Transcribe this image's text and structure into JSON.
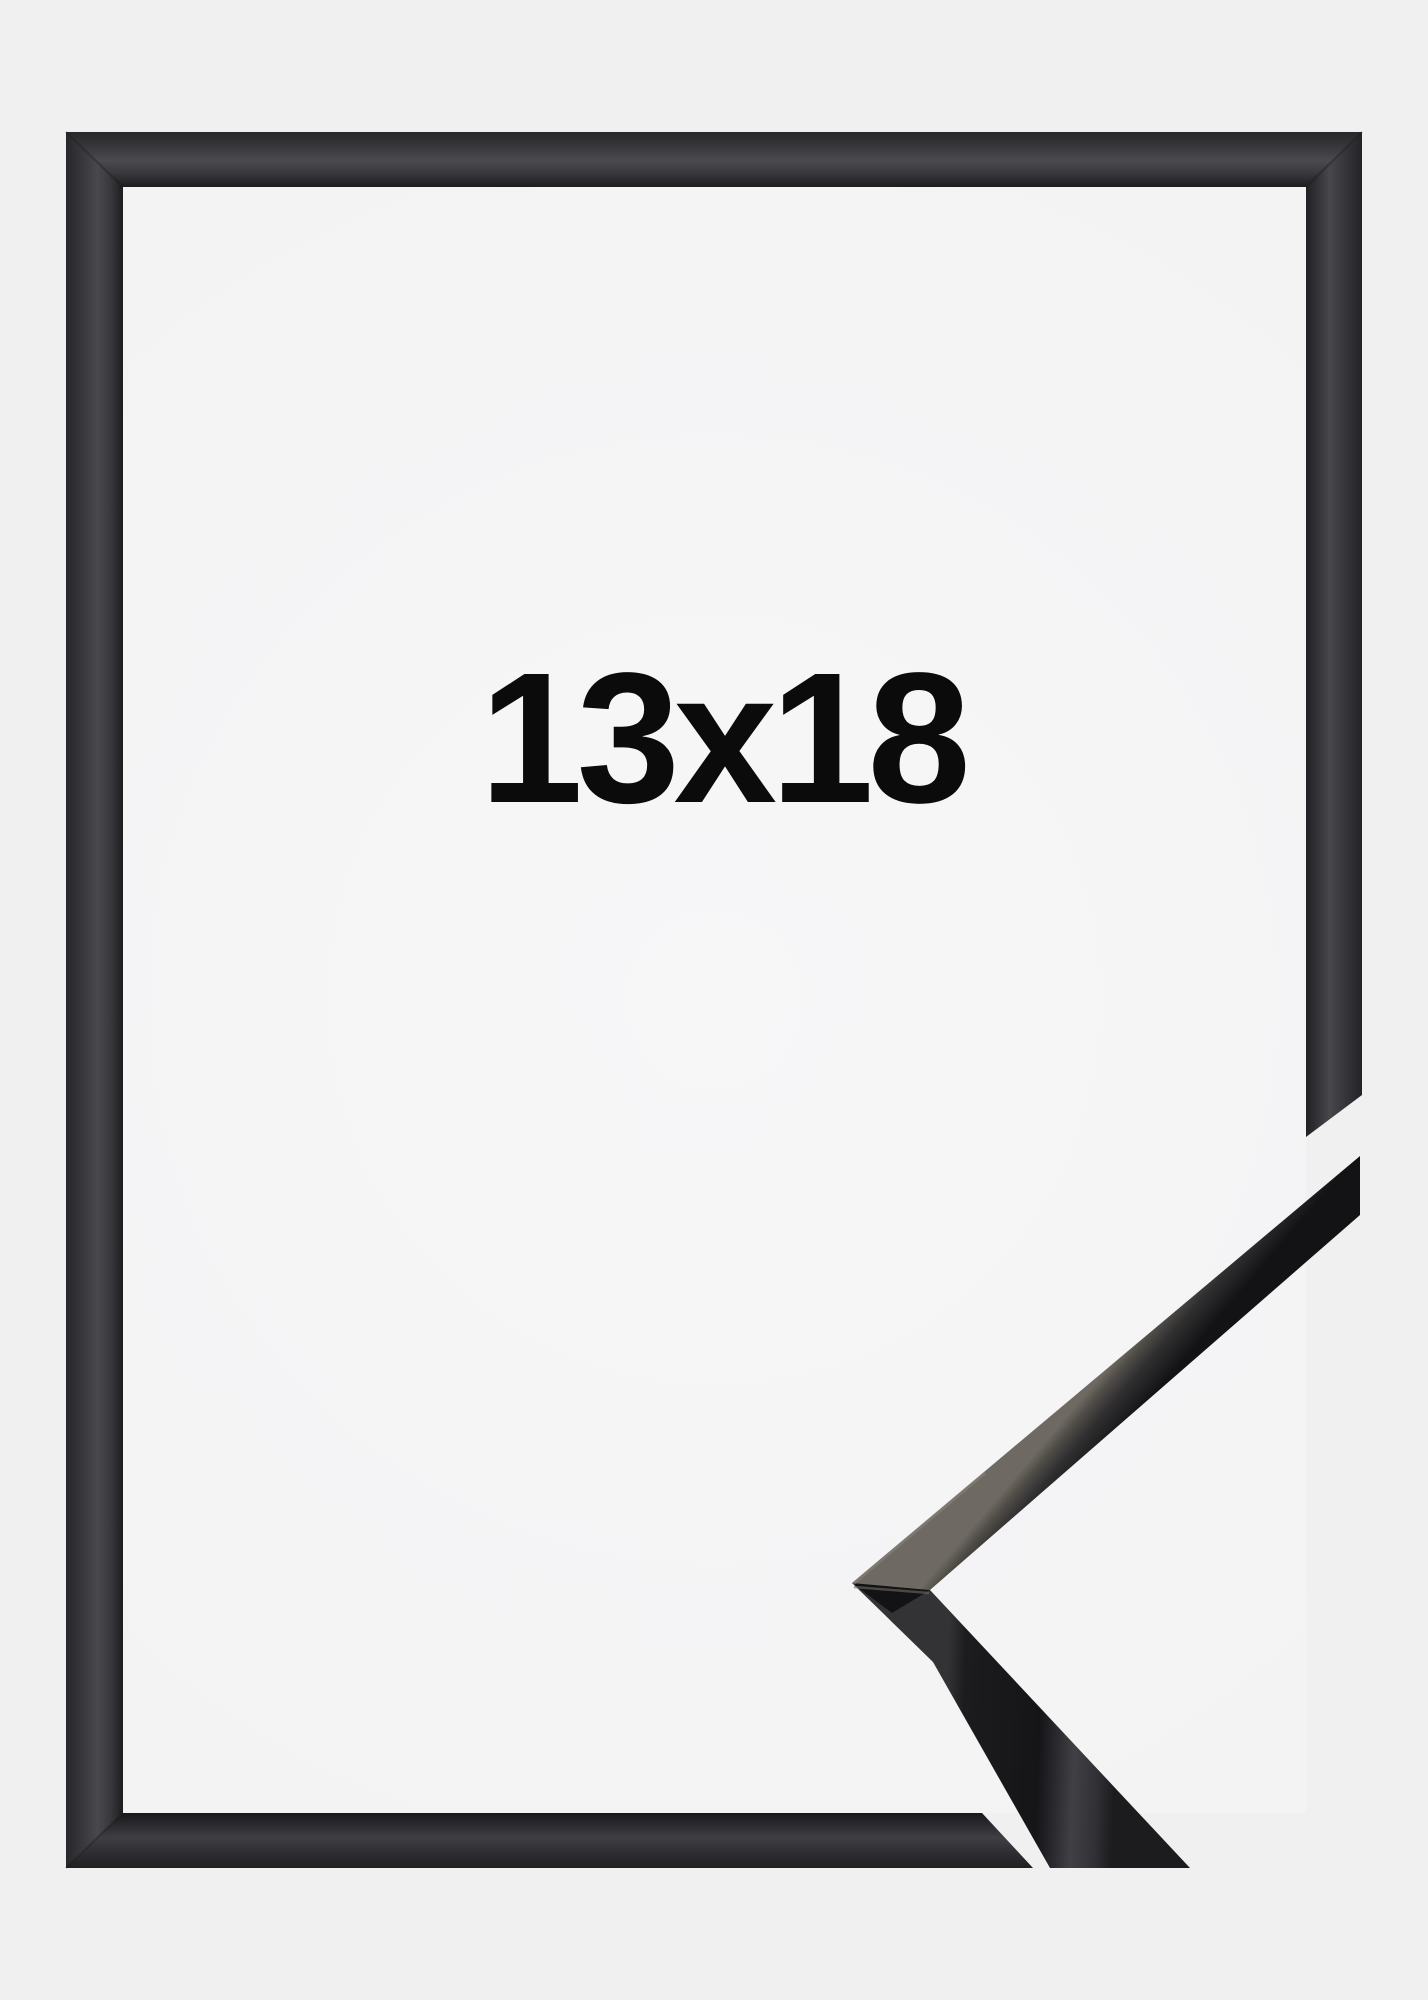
{
  "product_image": {
    "size_label": "13x18",
    "frame_color_name": "black",
    "colors": {
      "background": "#f0f0f1",
      "inner_background": "#f5f5f6",
      "frame_dark": "#1d1d20",
      "frame_mid": "#3a3a3e",
      "frame_highlight": "#4a4a4f",
      "corner_piece_highlight": "#6e6962",
      "label_text": "#0b0b0b"
    }
  }
}
